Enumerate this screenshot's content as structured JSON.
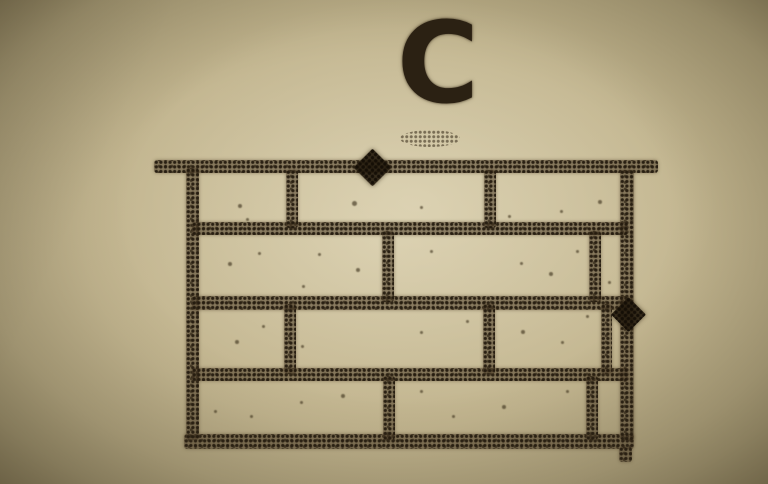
{
  "figure": {
    "label": "C"
  },
  "colors": {
    "ink": "#473a26",
    "ink_dark": "#261c0e",
    "paper_center": "#cfc3a0",
    "paper_edge": "#978b66",
    "label_color": "#2b2113"
  },
  "label_box": {
    "x": 378,
    "y": 8,
    "w": 120,
    "font_size": 112
  },
  "smudge": {
    "x": 400,
    "y": 130,
    "w": 60,
    "h": 17
  },
  "wall": {
    "top_line": {
      "x": 154,
      "y": 160,
      "w": 504,
      "h": 13
    },
    "bottom_line": {
      "x": 184,
      "y": 434,
      "w": 450,
      "h": 15
    },
    "left_edge": {
      "x": 186,
      "y": 168,
      "w": 13,
      "h": 272
    },
    "right_edge": {
      "x": 620,
      "y": 170,
      "w": 14,
      "h": 270
    },
    "corner_tail": {
      "x": 619,
      "y": 447,
      "w": 13,
      "h": 15
    },
    "bed_joints": [
      {
        "x": 192,
        "y": 222,
        "w": 436,
        "h": 13
      },
      {
        "x": 192,
        "y": 296,
        "w": 436,
        "h": 14
      },
      {
        "x": 192,
        "y": 368,
        "w": 436,
        "h": 13
      }
    ],
    "head_joints": [
      {
        "x": 286,
        "y": 170,
        "w": 12,
        "h": 58
      },
      {
        "x": 484,
        "y": 170,
        "w": 12,
        "h": 58
      },
      {
        "x": 382,
        "y": 231,
        "w": 12,
        "h": 71
      },
      {
        "x": 589,
        "y": 231,
        "w": 12,
        "h": 71
      },
      {
        "x": 284,
        "y": 304,
        "w": 12,
        "h": 70
      },
      {
        "x": 483,
        "y": 304,
        "w": 12,
        "h": 70
      },
      {
        "x": 601,
        "y": 304,
        "w": 11,
        "h": 70
      },
      {
        "x": 383,
        "y": 376,
        "w": 12,
        "h": 64
      },
      {
        "x": 586,
        "y": 376,
        "w": 12,
        "h": 64
      }
    ]
  },
  "markers": [
    {
      "name": "pointer-diamond-top",
      "cx": 372,
      "cy": 167,
      "size": 27
    },
    {
      "name": "pointer-diamond-right",
      "cx": 628,
      "cy": 314,
      "size": 25
    }
  ],
  "speckles": [
    [
      238,
      204,
      4
    ],
    [
      352,
      201,
      5
    ],
    [
      420,
      206,
      3
    ],
    [
      560,
      210,
      3
    ],
    [
      598,
      200,
      4
    ],
    [
      228,
      262,
      4
    ],
    [
      258,
      252,
      3
    ],
    [
      318,
      253,
      3
    ],
    [
      356,
      268,
      4
    ],
    [
      302,
      285,
      3
    ],
    [
      430,
      250,
      3
    ],
    [
      520,
      262,
      3
    ],
    [
      549,
      272,
      4
    ],
    [
      576,
      250,
      3
    ],
    [
      608,
      281,
      3
    ],
    [
      235,
      340,
      4
    ],
    [
      262,
      325,
      3
    ],
    [
      301,
      345,
      3
    ],
    [
      420,
      331,
      3
    ],
    [
      466,
      320,
      3
    ],
    [
      521,
      330,
      4
    ],
    [
      561,
      341,
      3
    ],
    [
      586,
      315,
      3
    ],
    [
      214,
      410,
      3
    ],
    [
      250,
      415,
      3
    ],
    [
      300,
      401,
      3
    ],
    [
      341,
      394,
      4
    ],
    [
      420,
      390,
      3
    ],
    [
      452,
      415,
      3
    ],
    [
      502,
      405,
      4
    ],
    [
      566,
      390,
      3
    ],
    [
      246,
      218,
      3
    ],
    [
      508,
      215,
      3
    ]
  ]
}
